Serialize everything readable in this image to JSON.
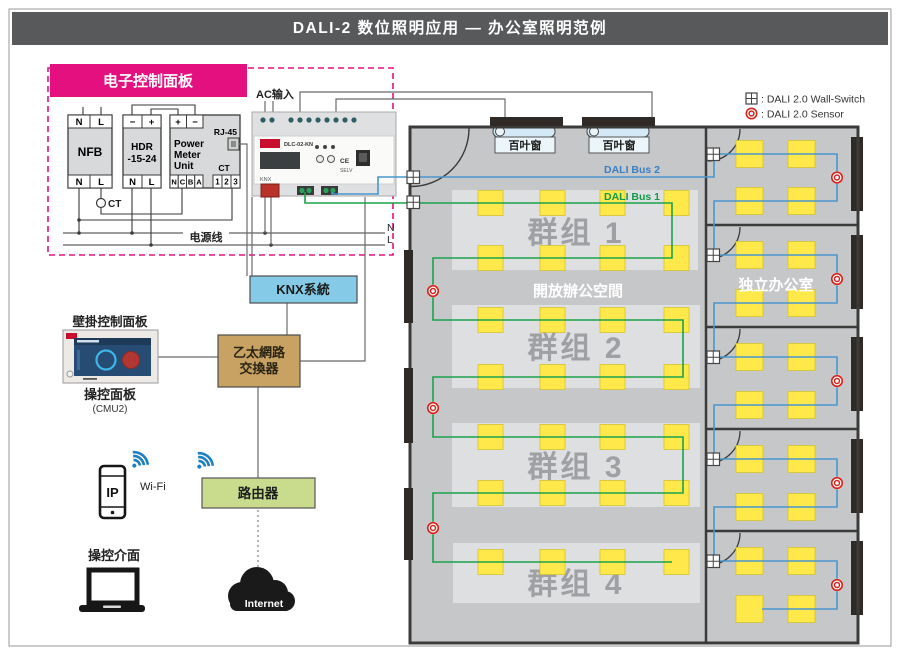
{
  "page": {
    "title": "DALI-2 数位照明应用 — 办公室照明范例"
  },
  "control_panel": {
    "title": "电子控制面板",
    "power_line_label": "电源线",
    "neutral_label": "N",
    "live_label": "L",
    "ct_label": "CT",
    "nfb": {
      "name": "NFB",
      "top": [
        "N",
        "L"
      ],
      "bottom": [
        "N",
        "L"
      ]
    },
    "hdr": {
      "name_line1": "HDR",
      "name_line2": "-15-24",
      "top": [
        "−",
        "+"
      ],
      "bottom": [
        "N",
        "L"
      ]
    },
    "power_meter": {
      "name_line1": "Power",
      "name_line2": "Meter",
      "name_line3": "Unit",
      "rj45_label": "RJ-45",
      "ct_label": "CT",
      "top": [
        "+",
        "−"
      ],
      "bottom_left": [
        "N",
        "C",
        "B",
        "A"
      ],
      "bottom_right": [
        "1",
        "2",
        "3"
      ]
    }
  },
  "dlc_controller": {
    "ac_input_label": "AC输入",
    "model": "DLC-02-KN",
    "knx_label": "KNX",
    "ce_label": "CE",
    "selv_label": "SELV"
  },
  "knx_box": {
    "label": "KNX系統"
  },
  "ethernet_switch": {
    "label_line1": "乙太網路",
    "label_line2": "交換器"
  },
  "wall_panel": {
    "title": "壁掛控制面板",
    "caption": "操控面板",
    "sub_caption": "(CMU2)"
  },
  "mobile": {
    "phone_label": "IP",
    "wifi_label": "Wi-Fi"
  },
  "router": {
    "label": "路由器"
  },
  "laptop": {
    "caption": "操控介面"
  },
  "cloud": {
    "label": "Internet"
  },
  "floor_plan": {
    "blinds": [
      "百叶窗",
      "百叶窗"
    ],
    "dali_bus_1_label": "DALI Bus 1",
    "dali_bus_2_label": "DALI Bus 2",
    "open_office_label": "開放辦公空間",
    "private_office_label": "独立办公室",
    "groups": [
      "群组 1",
      "群组 2",
      "群组 3",
      "群组 4"
    ],
    "legend": [
      {
        "icon": "wall-switch-icon",
        "label": ":  DALI 2.0 Wall-Switch"
      },
      {
        "icon": "sensor-icon",
        "label": ":  DALI 2.0 Sensor"
      }
    ]
  },
  "colors": {
    "accent_pink": "#E5107F",
    "header_gray": "#58595B",
    "knx_blue": "#85CBE8",
    "switch_tan": "#C8A263",
    "router_green": "#C9DC8E",
    "dali_bus1_green": "#18A24B",
    "dali_bus2_blue": "#4A96CE",
    "light_yellow": "#FFE84A",
    "light_border": "#D4C22E",
    "sensor_red": "#D6251D",
    "wifi_blue": "#1E7FC2",
    "floor_gray": "#C6C7C9",
    "zone_gray": "#DEDFE1",
    "zone_text_gray": "#9EA0A3",
    "wall_dark": "#3B3B3A"
  }
}
